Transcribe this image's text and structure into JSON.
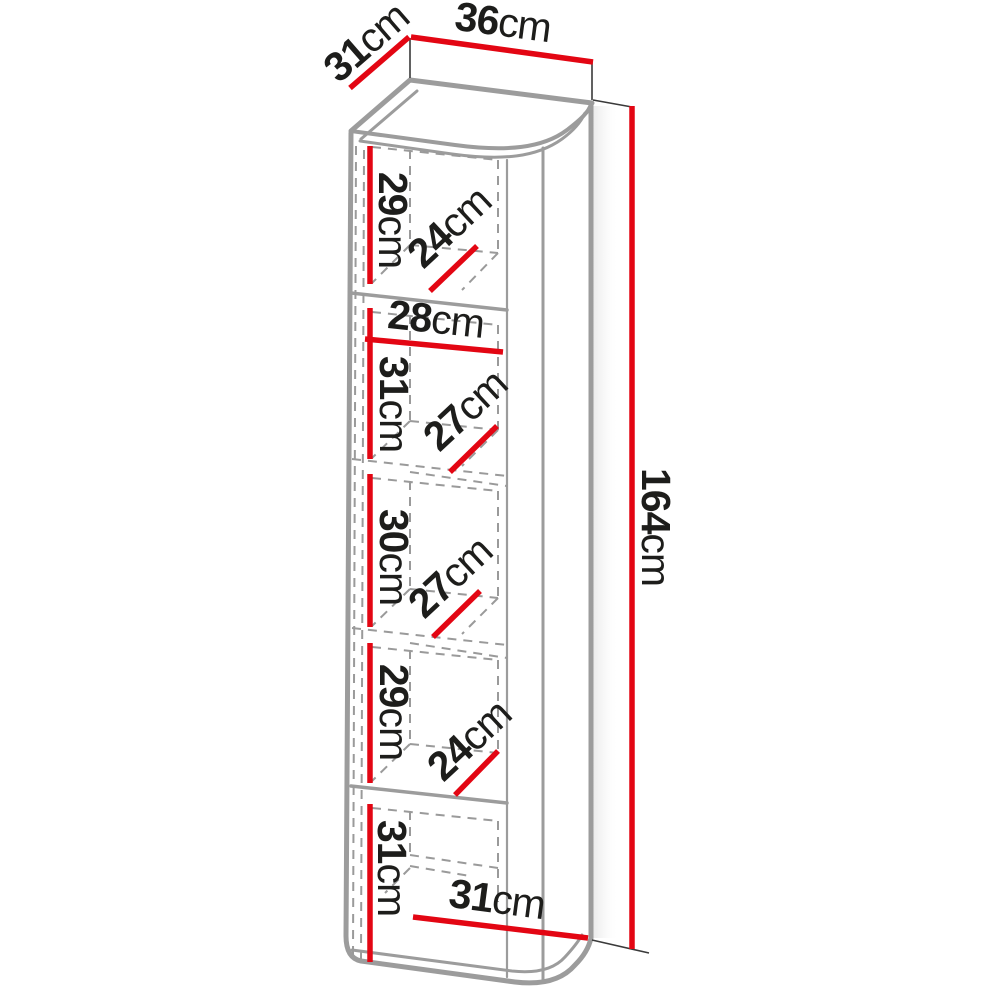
{
  "diagram": {
    "type": "furniture-dimension-diagram",
    "subject": "tall narrow five-compartment shelf cabinet, 3D line drawing with red dimension lines",
    "unit": "cm",
    "colors": {
      "dimension_line": "#e30613",
      "outline": "#9c9c9c",
      "hidden_line": "#9a9a9a",
      "label_text": "#1d1d1b",
      "background": "#ffffff"
    },
    "dims": {
      "top_depth": {
        "value": "31",
        "unit": "cm"
      },
      "top_width": {
        "value": "36",
        "unit": "cm"
      },
      "height": {
        "value": "164",
        "unit": "cm"
      },
      "c1_height": {
        "value": "29",
        "unit": "cm"
      },
      "c1_depth": {
        "value": "24",
        "unit": "cm"
      },
      "inner_width": {
        "value": "28",
        "unit": "cm"
      },
      "c2_height": {
        "value": "31",
        "unit": "cm"
      },
      "c2_depth": {
        "value": "27",
        "unit": "cm"
      },
      "c3_height": {
        "value": "30",
        "unit": "cm"
      },
      "c3_depth": {
        "value": "27",
        "unit": "cm"
      },
      "c4_height": {
        "value": "29",
        "unit": "cm"
      },
      "c4_depth": {
        "value": "24",
        "unit": "cm"
      },
      "c5_height": {
        "value": "31",
        "unit": "cm"
      },
      "bottom_depth": {
        "value": "31",
        "unit": "cm"
      }
    }
  }
}
